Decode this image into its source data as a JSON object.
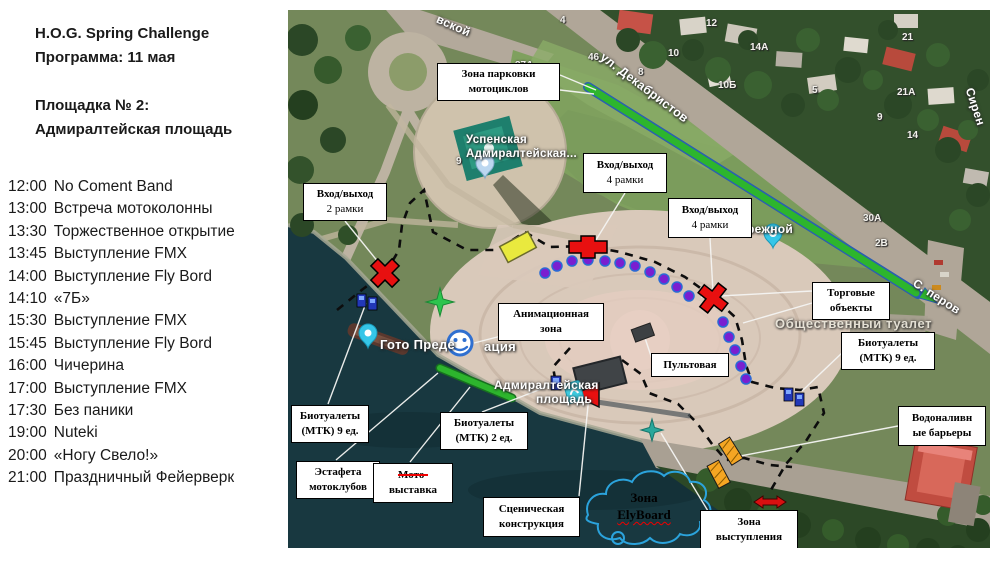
{
  "header": {
    "line1": "H.O.G. Spring Challenge",
    "line2": "Программа: 11 мая",
    "line3": "Площадка № 2:",
    "line4": "Адмиралтейская площадь"
  },
  "schedule": [
    {
      "time": "12:00",
      "event": "No Coment Band"
    },
    {
      "time": "13:00",
      "event": "Встреча мотоколонны"
    },
    {
      "time": "13:30",
      "event": "Торжественное открытие"
    },
    {
      "time": "13:45",
      "event": "Выступление FMX"
    },
    {
      "time": "14:00",
      "event": "Выступление Fly Bord"
    },
    {
      "time": "14:10",
      "event": "«7Б»"
    },
    {
      "time": "15:30",
      "event": "Выступление FMX"
    },
    {
      "time": "15:45",
      "event": "Выступление Fly Bord"
    },
    {
      "time": "16:00",
      "event": "Чичерина"
    },
    {
      "time": "17:00",
      "event": "Выступление FMX"
    },
    {
      "time": "17:30",
      "event": "Без паники"
    },
    {
      "time": "19:00",
      "event": "Nuteki"
    },
    {
      "time": "20:00",
      "event": "«Ногу Свело!»"
    },
    {
      "time": "21:00",
      "event": "Праздничный Фейерверк"
    }
  ],
  "map": {
    "labels": [
      {
        "id": "parking",
        "line1": "Зона парковки",
        "line2": "мотоциклов"
      },
      {
        "id": "entry-2",
        "line1": "Вход/выход",
        "line2": "2 рамки"
      },
      {
        "id": "entry-4a",
        "line1": "Вход/выход",
        "line2": "4 рамки"
      },
      {
        "id": "entry-4b",
        "line1": "Вход/выход",
        "line2": "4 рамки"
      },
      {
        "id": "animation",
        "line1": "Анимационная",
        "line2": "зона"
      },
      {
        "id": "trade",
        "line1": "Торговые",
        "line2": "объекты"
      },
      {
        "id": "bio9-right",
        "line1": "Биотуалеты",
        "line2": "(МТК) 9 ед."
      },
      {
        "id": "pult",
        "line1": "Пультовая",
        "line2": ""
      },
      {
        "id": "bio9-left",
        "line1": "Биотуалеты",
        "line2": "(МТК) 9 ед."
      },
      {
        "id": "bio2",
        "line1": "Биотуалеты",
        "line2": "(МТК) 2 ед."
      },
      {
        "id": "water-barriers",
        "line1": "Водоналивн",
        "line2": "ые барьеры"
      },
      {
        "id": "relay",
        "line1": "Эстафета",
        "line2": "мотоклубов"
      },
      {
        "id": "stage",
        "line1": "Сценическая",
        "line2": "конструкция"
      },
      {
        "id": "perform",
        "line1": "Зона",
        "line2": "выступления"
      }
    ],
    "moto_label": {
      "struck": "Мото-",
      "rest": "выставка"
    },
    "cloud": {
      "line1": "Зона",
      "line2": "ElyBoard"
    },
    "places": [
      "ул. Декабристов",
      "вской",
      "Успенская",
      "Адмиралтейская...",
      "Гото Преде",
      "ация",
      "Адмиралтейская",
      "площадь",
      "Общественный туалет",
      "ережной",
      "С. перов",
      "Сирен"
    ],
    "house_numbers": [
      "4",
      "12",
      "46",
      "10",
      "8",
      "14А",
      "10Б",
      "37А",
      "5",
      "21",
      "21А",
      "9",
      "14",
      "30А",
      "2В",
      "9"
    ],
    "colors": {
      "parking_strip": "#2db52d",
      "perimeter": "#111111",
      "trade_point": "#7a1fd0",
      "entrance_marker": "#e81010",
      "cloud_outline": "#2ba3dc"
    }
  }
}
